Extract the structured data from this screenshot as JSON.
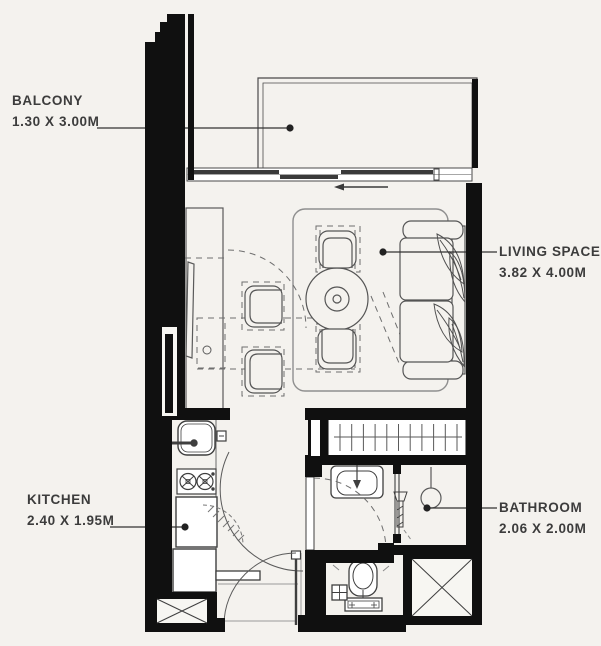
{
  "plan": {
    "rooms": {
      "balcony": {
        "label": "BALCONY",
        "dimensions": "1.30 X 3.00M"
      },
      "living_space": {
        "label": "LIVING SPACE",
        "dimensions": "3.82 X 4.00M"
      },
      "kitchen": {
        "label": "KITCHEN",
        "dimensions": "2.40 X 1.95M"
      },
      "bathroom": {
        "label": "BATHROOM",
        "dimensions": "2.06 X 2.00M"
      }
    },
    "colors": {
      "background": "#f4f2ee",
      "wall": "#101010",
      "line": "#4a4a4a",
      "text": "#3c3c3c"
    }
  }
}
